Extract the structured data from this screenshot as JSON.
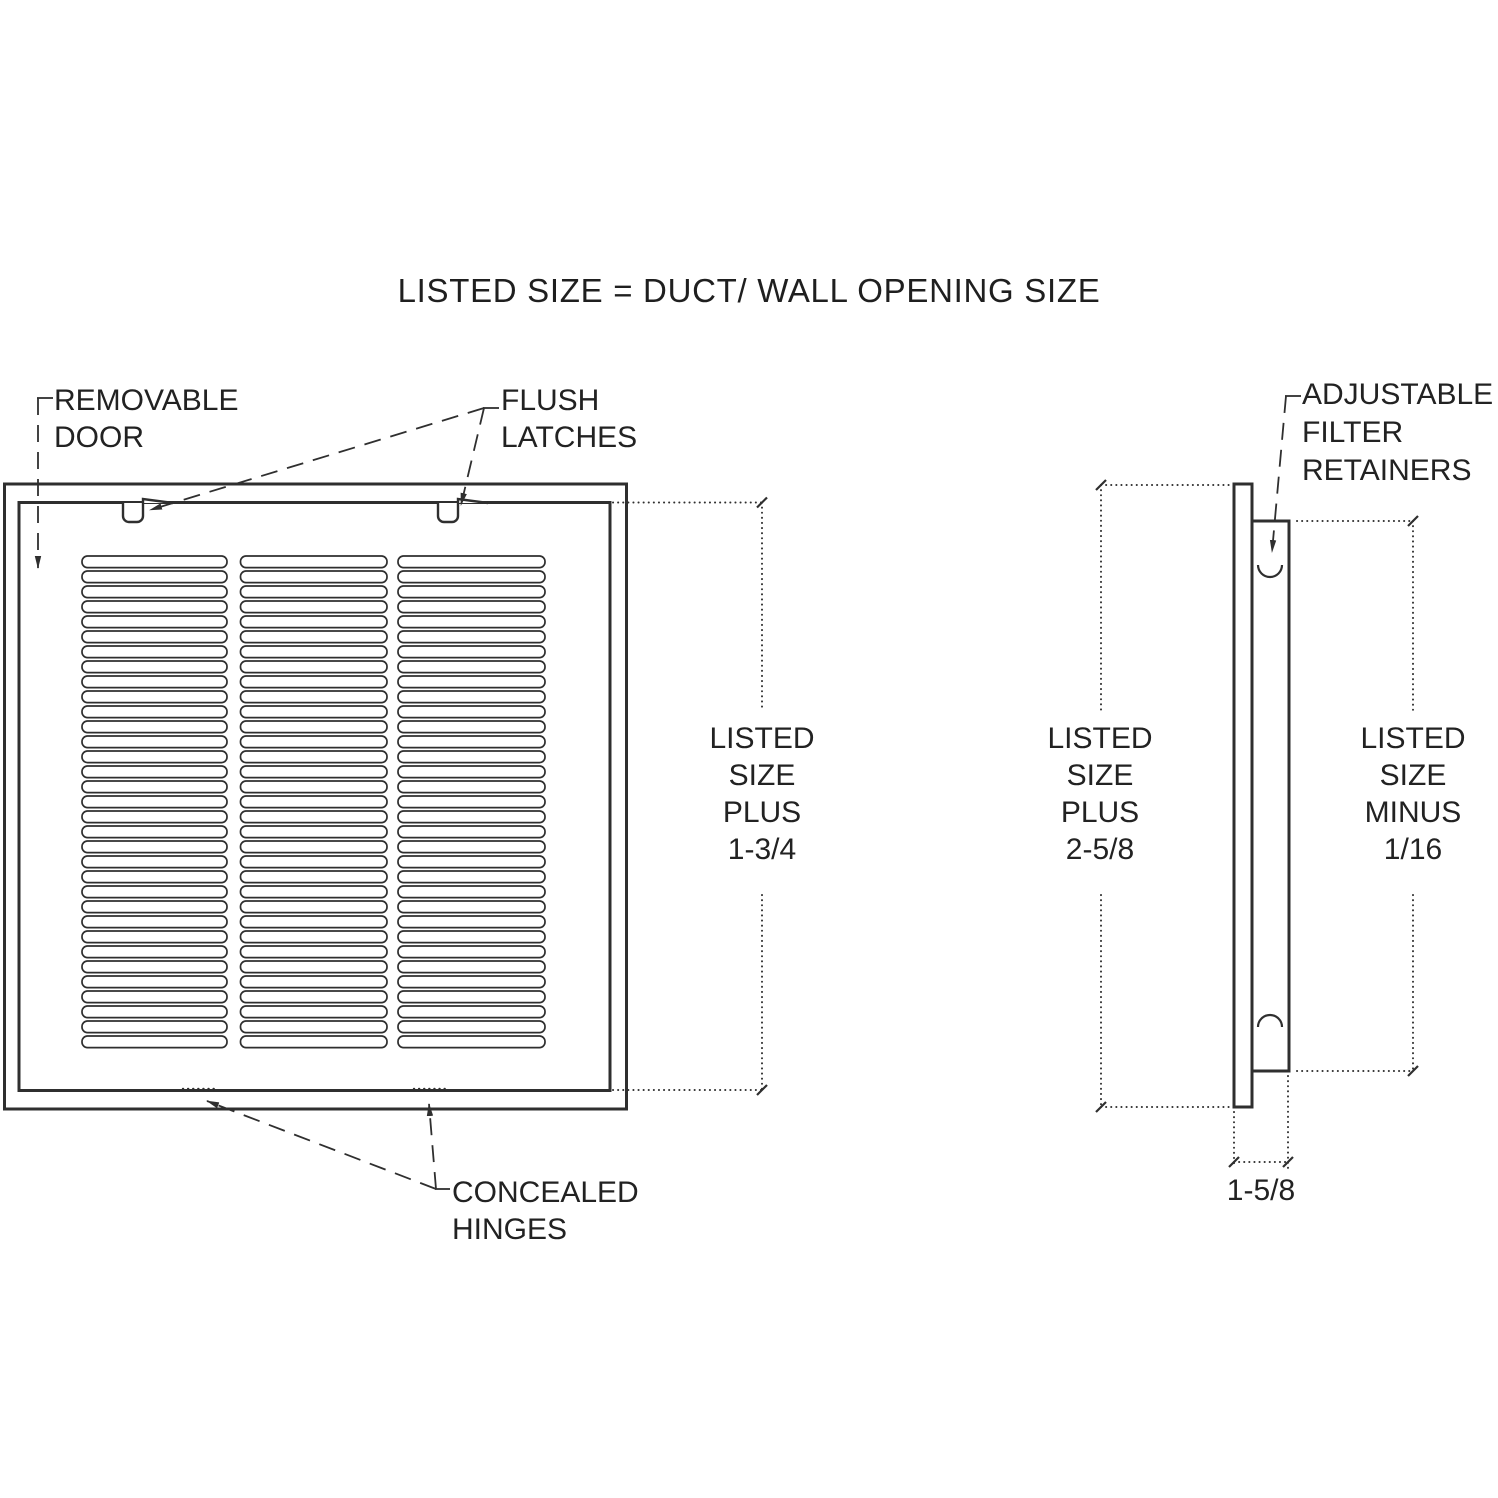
{
  "title": "LISTED SIZE = DUCT/ WALL OPENING SIZE",
  "front_view": {
    "labels": {
      "removable_door": "REMOVABLE\nDOOR",
      "flush_latches": "FLUSH\nLATCHES",
      "concealed_hinges": "CONCEALED\nHINGES"
    },
    "dimension_height": "LISTED\nSIZE\nPLUS\n1-3/4",
    "grille": {
      "louver_columns": 3,
      "louver_rows": 33
    }
  },
  "side_view": {
    "labels": {
      "adjustable_filter_retainers": "ADJUSTABLE\nFILTER\nRETAINERS"
    },
    "dimension_overall": "LISTED\nSIZE\nPLUS\n2-5/8",
    "dimension_filter_opening": "LISTED\nSIZE\nMINUS\n1/16",
    "dimension_depth": "1-5/8"
  },
  "colors": {
    "line": "#2f2f2f",
    "text": "#222222",
    "background": "#ffffff"
  }
}
